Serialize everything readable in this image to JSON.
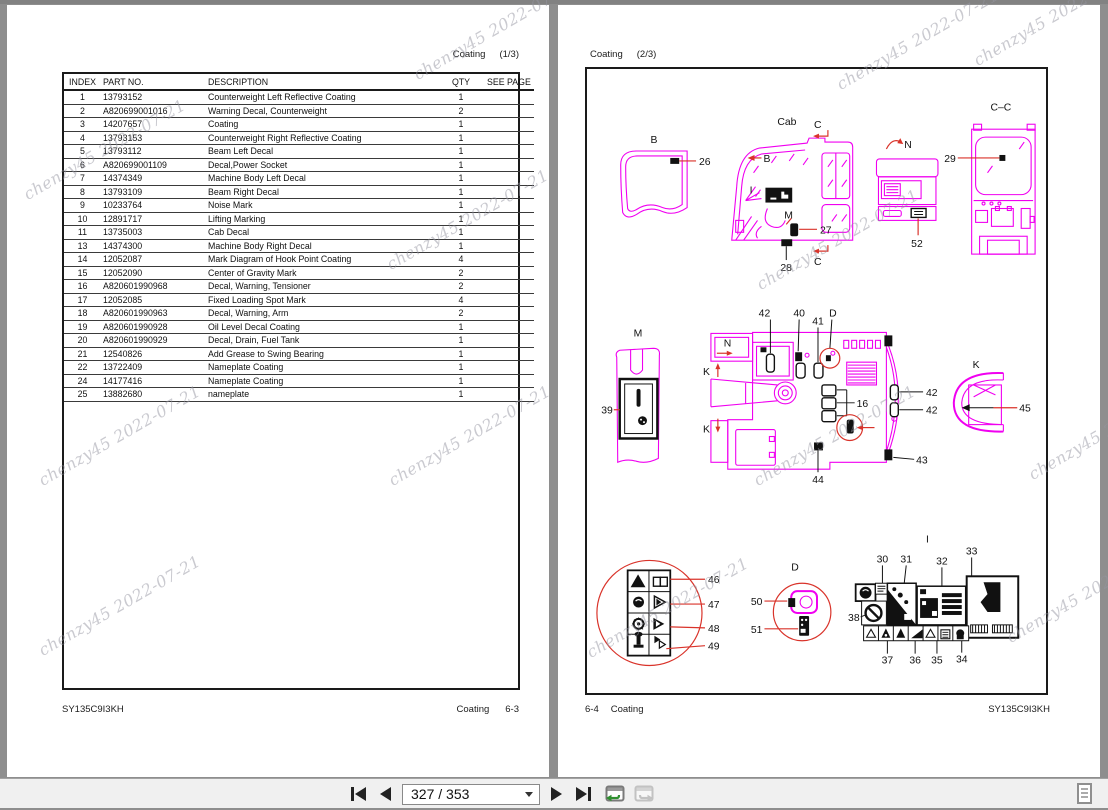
{
  "watermark": {
    "text": "chenzy45 2022-07-21"
  },
  "toolbar": {
    "page_indicator": "327 / 353"
  },
  "left_page": {
    "header_label": "Coating",
    "header_page": "(1/3)",
    "footer_model": "SY135C9I3KH",
    "footer_section": "Coating",
    "footer_page": "6-3",
    "table": {
      "columns": [
        "INDEX",
        "PART NO.",
        "DESCRIPTION",
        "QTY",
        "SEE PAGE"
      ],
      "rows": [
        [
          "1",
          "13793152",
          "Counterweight Left Reflective Coating",
          "1",
          ""
        ],
        [
          "2",
          "A820699001016",
          "Warning Decal, Counterweight",
          "2",
          ""
        ],
        [
          "3",
          "14207657",
          "Coating",
          "1",
          ""
        ],
        [
          "4",
          "13793153",
          "Counterweight Right Reflective Coating",
          "1",
          ""
        ],
        [
          "5",
          "13793112",
          "Beam Left Decal",
          "1",
          ""
        ],
        [
          "6",
          "A820699001109",
          "Decal,Power Socket",
          "1",
          ""
        ],
        [
          "7",
          "14374349",
          "Machine Body Left Decal",
          "1",
          ""
        ],
        [
          "8",
          "13793109",
          "Beam Right Decal",
          "1",
          ""
        ],
        [
          "9",
          "10233764",
          "Noise Mark",
          "1",
          ""
        ],
        [
          "10",
          "12891717",
          "Lifting Marking",
          "1",
          ""
        ],
        [
          "11",
          "13735003",
          "Cab Decal",
          "1",
          ""
        ],
        [
          "13",
          "14374300",
          "Machine Body Right Decal",
          "1",
          ""
        ],
        [
          "14",
          "12052087",
          "Mark Diagram of Hook Point Coating",
          "4",
          ""
        ],
        [
          "15",
          "12052090",
          "Center of Gravity Mark",
          "2",
          ""
        ],
        [
          "16",
          "A820601990968",
          "Decal, Warning, Tensioner",
          "2",
          ""
        ],
        [
          "17",
          "12052085",
          "Fixed Loading Spot Mark",
          "4",
          ""
        ],
        [
          "18",
          "A820601990963",
          "Decal, Warning, Arm",
          "2",
          ""
        ],
        [
          "19",
          "A820601990928",
          "Oil Level Decal Coating",
          "1",
          ""
        ],
        [
          "20",
          "A820601990929",
          "Decal, Drain, Fuel Tank",
          "1",
          ""
        ],
        [
          "21",
          "12540826",
          "Add Grease to Swing Bearing",
          "1",
          ""
        ],
        [
          "22",
          "13722409",
          "Nameplate Coating",
          "1",
          ""
        ],
        [
          "24",
          "14177416",
          "Nameplate Coating",
          "1",
          ""
        ],
        [
          "25",
          "13882680",
          "nameplate",
          "1",
          ""
        ]
      ]
    }
  },
  "right_page": {
    "header_label": "Coating",
    "header_page": "(2/3)",
    "footer_page": "6-4",
    "footer_section": "Coating",
    "footer_model": "SY135C9I3KH",
    "diagram": {
      "labels": {
        "b": "B",
        "b_cab": "B",
        "cab": "Cab",
        "c_top": "C",
        "c_bot": "C",
        "i_cab": "I",
        "m_cab": "M",
        "n_top": "N",
        "cc": "C–C",
        "m_det": "M",
        "n_mid": "N",
        "k_top": "K",
        "k_bot": "K",
        "k_det": "K",
        "d_top": "D",
        "d_det": "D",
        "i_det": "I"
      },
      "nums": {
        "n16": "16",
        "n26": "26",
        "n27": "27",
        "n28": "28",
        "n29": "29",
        "n30": "30",
        "n31": "31",
        "n32": "32",
        "n33": "33",
        "n34": "34",
        "n35": "35",
        "n36": "36",
        "n37": "37",
        "n38": "38",
        "n39": "39",
        "n40": "40",
        "n41": "41",
        "n42a": "42",
        "n42b": "42",
        "n42c": "42",
        "n43": "43",
        "n44": "44",
        "n45": "45",
        "n46": "46",
        "n47": "47",
        "n48": "48",
        "n49": "49",
        "n50": "50",
        "n51": "51",
        "n52": "52"
      }
    }
  }
}
